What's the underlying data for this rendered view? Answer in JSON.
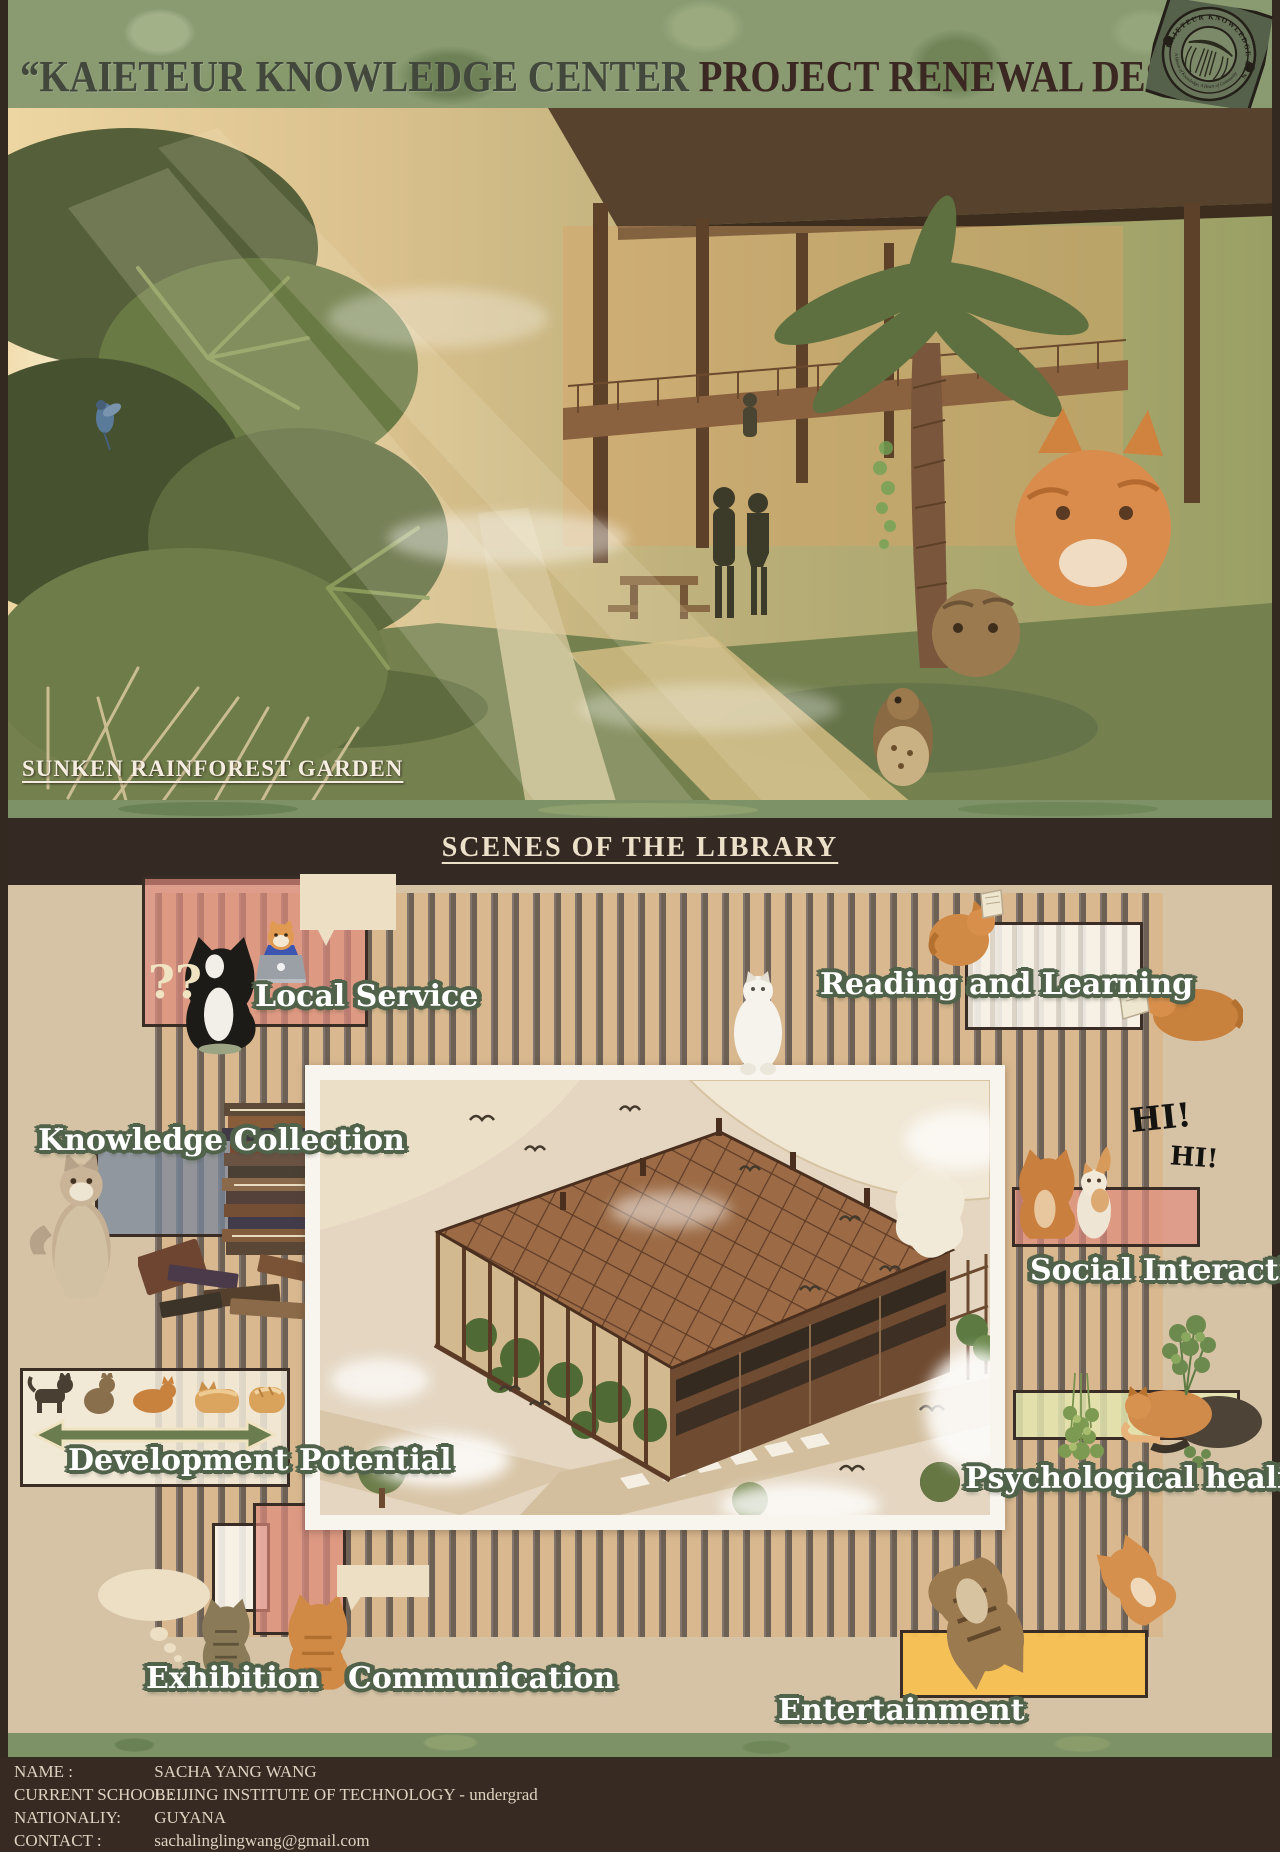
{
  "header": {
    "title_part1": "“KAIETEUR KNOWLEDGE CENTER ",
    "title_part2": "PROJECT RENEWAL DESIGN”"
  },
  "logo": {
    "ring_text_top": "KAIETEUR KNOWLEDGE CENTER",
    "ring_text_bottom": "A Haven of Knowledge, A Heart of Community"
  },
  "hero": {
    "caption": "SUNKEN RAINFOREST GARDEN"
  },
  "section": {
    "heading": "SCENES OF THE LIBRARY"
  },
  "scenes": {
    "local_service": "Local Service",
    "reading_learning": "Reading and Learning",
    "knowledge_collection": "Knowledge Collection",
    "social_interaction": "Social Interaction",
    "development_potential": "Development Potential",
    "psychological_healing": "Psychological healing",
    "exhibition": "Exhibition",
    "communication": "Communication",
    "entertainment": "Entertainment",
    "hi_1": "HI!",
    "hi_2": "HI!",
    "question_marks": "??"
  },
  "footer": {
    "rows": [
      {
        "label": "NAME :",
        "value": "SACHA YANG WANG"
      },
      {
        "label": "CURRENT SCHOOL :",
        "value": "BEIJING INSTITUTE OF TECHNOLOGY - undergrad"
      },
      {
        "label": "NATIONALIY:",
        "value": "GUYANA"
      },
      {
        "label": "CONTACT :",
        "value": "sachalinglingwang@gmail.com"
      }
    ]
  },
  "colors": {
    "frame_brown": "#342921",
    "header_green": "#8a9b72",
    "section_tan": "#d6c3a6",
    "stripe_dark": "#6d6054",
    "stripe_tan": "#d9b88f",
    "pink_box": "#e08b7d",
    "slate_box": "#76869c",
    "pale_green_box": "#e5e9b2",
    "yellow_box": "#f7c152",
    "label_outline_green": "#51624a",
    "band_brown": "#352a23",
    "cream": "#ecdfc4"
  }
}
